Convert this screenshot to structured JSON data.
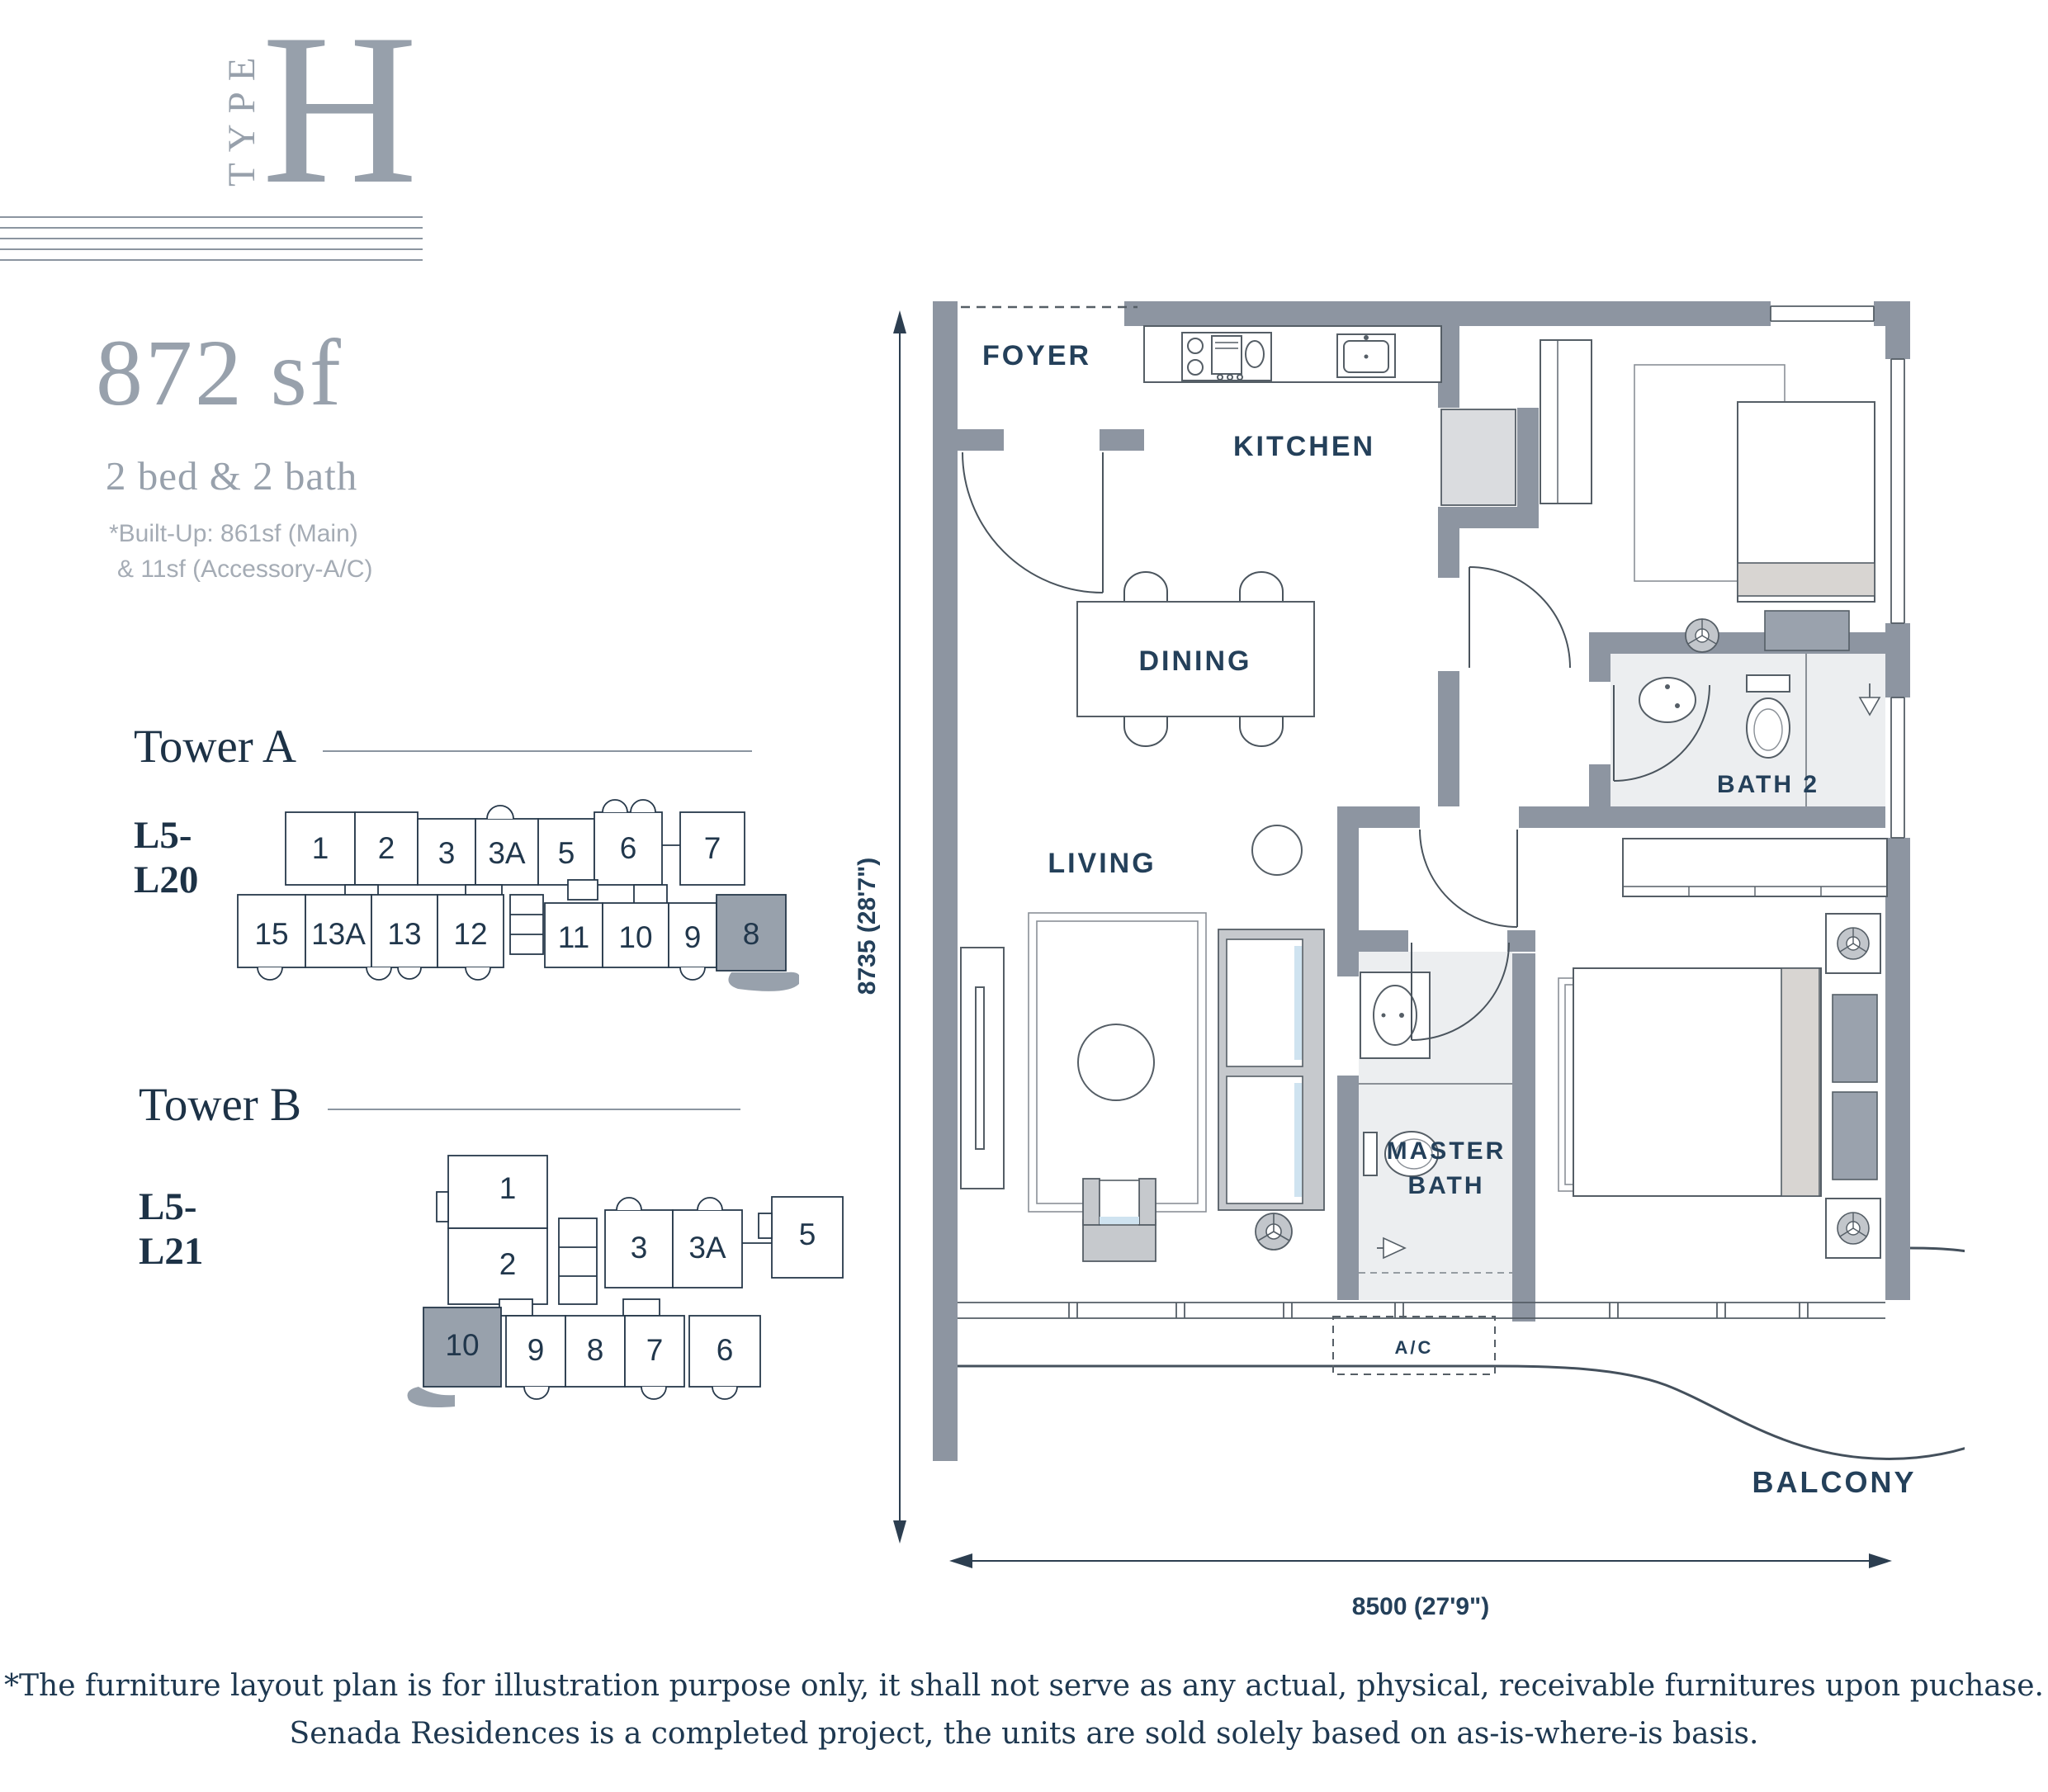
{
  "logo": {
    "type_vertical": "TYPE",
    "letter": "H"
  },
  "summary": {
    "area": "872 sf",
    "layout": "2 bed & 2 bath",
    "builtup_line1": "*Built-Up: 861sf (Main)",
    "builtup_line2": "& 11sf (Accessory-A/C)"
  },
  "towers": [
    {
      "name": "Tower A",
      "levels_line1": "L5-",
      "levels_line2": "L20",
      "highlighted_unit": "8",
      "units_top": [
        "1",
        "2",
        "3",
        "3A",
        "5",
        "6",
        "7"
      ],
      "units_bottom": [
        "15",
        "13A",
        "13",
        "12",
        "11",
        "10",
        "9",
        "8"
      ]
    },
    {
      "name": "Tower B",
      "levels_line1": "L5-",
      "levels_line2": "L21",
      "highlighted_unit": "10",
      "units_left": [
        "1",
        "2"
      ],
      "units_top": [
        "3",
        "3A",
        "5"
      ],
      "units_bottom": [
        "10",
        "9",
        "8",
        "7",
        "6"
      ]
    }
  ],
  "floor_plan": {
    "rooms": {
      "foyer": "FOYER",
      "kitchen": "KITCHEN",
      "dining": "DINING",
      "living": "LIVING",
      "bath2": "BATH 2",
      "master_bath_line1": "MASTER",
      "master_bath_line2": "BATH",
      "ac": "A/C",
      "balcony": "BALCONY"
    },
    "dimensions": {
      "width": "8500 (27'9\")",
      "height": "8735 (28'7\")"
    }
  },
  "colors": {
    "accent_gray": "#98a1ac",
    "navy": "#1d3246",
    "wall": "#8d95a1"
  },
  "disclaimer": {
    "line1": "*The furniture layout plan is for illustration purpose only, it shall not serve as any actual, physical, receivable furnitures upon puchase.",
    "line2": "Senada Residences is a completed project, the units are sold solely based on as-is-where-is basis."
  }
}
